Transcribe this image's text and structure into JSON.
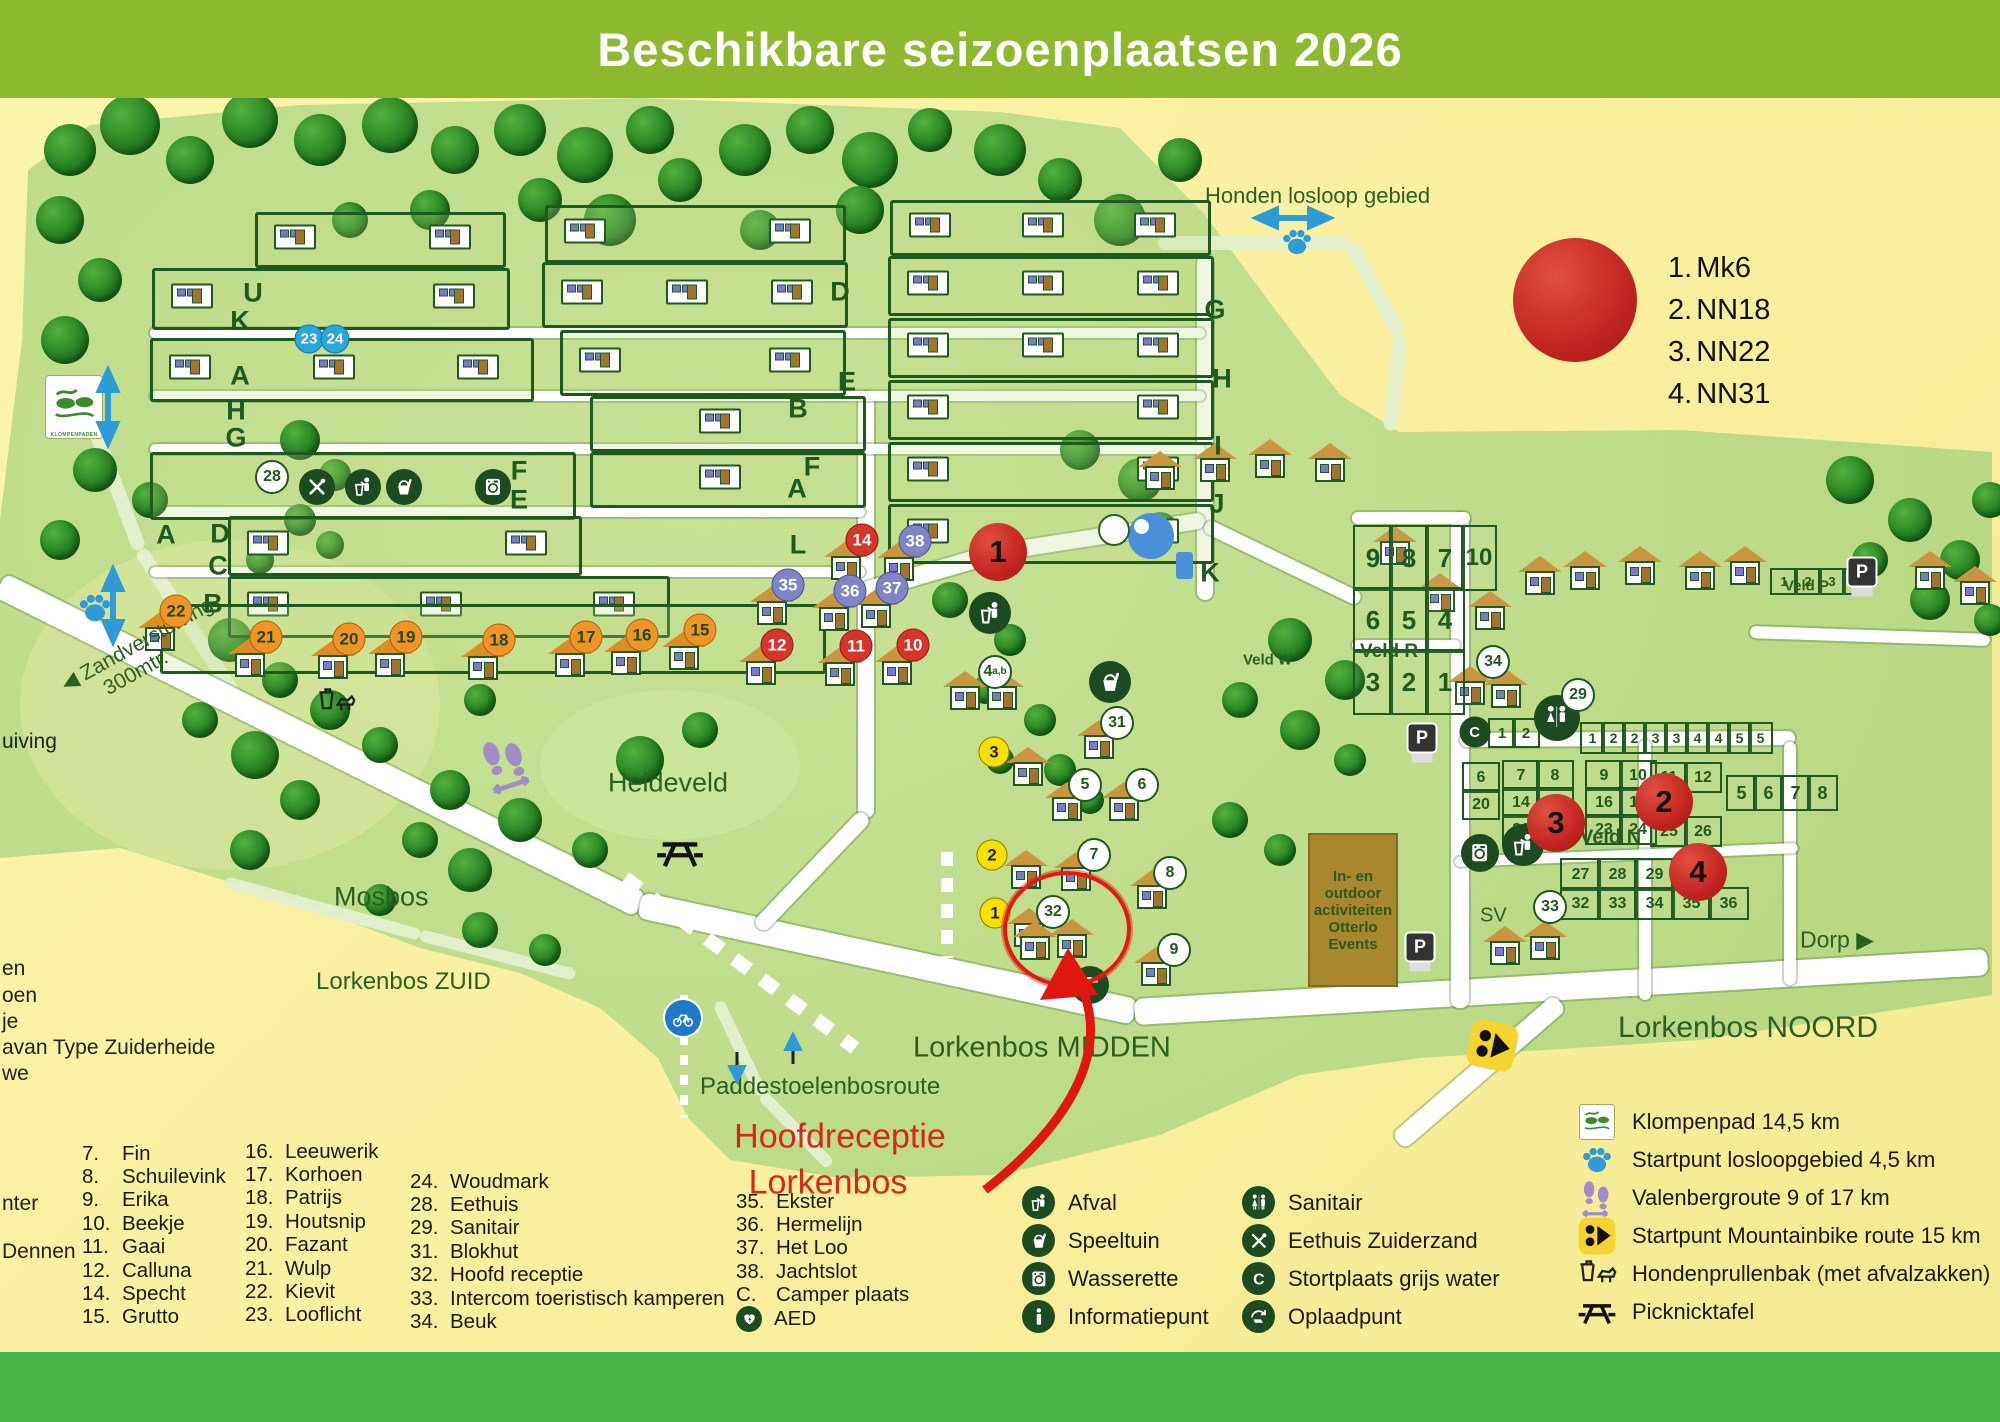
{
  "title": "Beschikbare seizoenplaatsen 2026",
  "availability_legend": {
    "items": [
      {
        "num": "1.",
        "label": "Mk6"
      },
      {
        "num": "2.",
        "label": "NN18"
      },
      {
        "num": "3.",
        "label": "NN22"
      },
      {
        "num": "4.",
        "label": "NN31"
      }
    ]
  },
  "highlight": {
    "line1": "Hoofdreceptie",
    "line2": "Lorkenbos"
  },
  "map_labels": [
    {
      "id": "honden",
      "text": "Honden losloop gebied",
      "x": 1205,
      "y": 196,
      "size": 22
    },
    {
      "id": "heideveld",
      "text": "Heideveld",
      "x": 608,
      "y": 783,
      "size": 27
    },
    {
      "id": "mosbos",
      "text": "Mosbos",
      "x": 334,
      "y": 897,
      "size": 27
    },
    {
      "id": "zuid",
      "text": "Lorkenbos ZUID",
      "x": 316,
      "y": 982,
      "size": 24
    },
    {
      "id": "midden",
      "text": "Lorkenbos MIDDEN",
      "x": 913,
      "y": 1048,
      "size": 29
    },
    {
      "id": "noord",
      "text": "Lorkenbos NOORD",
      "x": 1618,
      "y": 1028,
      "size": 30
    },
    {
      "id": "paddestoelen",
      "text": "Paddestoelenbosroute",
      "x": 700,
      "y": 1087,
      "size": 24
    },
    {
      "id": "zandverstuiving",
      "text": "◀ Zandverstuiving\n      300mtr.",
      "x": 58,
      "y": 655,
      "size": 21,
      "rot": -29
    },
    {
      "id": "veld-r",
      "text": "Veld R",
      "x": 1360,
      "y": 652,
      "size": 19,
      "bold": true
    },
    {
      "id": "veld-n",
      "text": "Veld N",
      "x": 1580,
      "y": 838,
      "size": 20,
      "bold": true
    },
    {
      "id": "veld-w",
      "text": "Veld W",
      "x": 1243,
      "y": 660,
      "size": 15,
      "bold": true
    },
    {
      "id": "veld-p",
      "text": "Veld P",
      "x": 1784,
      "y": 586,
      "size": 15,
      "bold": true
    },
    {
      "id": "sv",
      "text": "SV",
      "x": 1480,
      "y": 916,
      "size": 20
    },
    {
      "id": "dorp",
      "text": "Dorp ▶",
      "x": 1800,
      "y": 940,
      "size": 23
    }
  ],
  "events_box_text": "In- en\noutdoor\nactiviteiten\nOtterlo\nEvents",
  "klompenpad_sign_text": "KLOMPENPADEN",
  "row_letters": [
    {
      "ch": "U",
      "x": 253,
      "y": 293
    },
    {
      "ch": "K",
      "x": 240,
      "y": 321
    },
    {
      "ch": "A",
      "x": 240,
      "y": 376
    },
    {
      "ch": "H",
      "x": 236,
      "y": 411
    },
    {
      "ch": "G",
      "x": 236,
      "y": 438
    },
    {
      "ch": "A",
      "x": 166,
      "y": 535
    },
    {
      "ch": "D",
      "x": 220,
      "y": 534
    },
    {
      "ch": "C",
      "x": 218,
      "y": 566
    },
    {
      "ch": "B",
      "x": 213,
      "y": 604
    },
    {
      "ch": "D",
      "x": 840,
      "y": 292
    },
    {
      "ch": "E",
      "x": 847,
      "y": 382
    },
    {
      "ch": "B",
      "x": 798,
      "y": 409
    },
    {
      "ch": "F",
      "x": 812,
      "y": 467
    },
    {
      "ch": "A",
      "x": 797,
      "y": 489
    },
    {
      "ch": "L",
      "x": 798,
      "y": 545
    },
    {
      "ch": "F",
      "x": 519,
      "y": 471
    },
    {
      "ch": "E",
      "x": 519,
      "y": 500
    },
    {
      "ch": "G",
      "x": 1215,
      "y": 310
    },
    {
      "ch": "H",
      "x": 1222,
      "y": 379
    },
    {
      "ch": "I",
      "x": 1218,
      "y": 446
    },
    {
      "ch": "J",
      "x": 1217,
      "y": 504
    },
    {
      "ch": "K",
      "x": 1210,
      "y": 573
    }
  ],
  "markers": [
    {
      "n": "23",
      "t": "blue",
      "x": 309,
      "y": 339
    },
    {
      "n": "24",
      "t": "blue",
      "x": 335,
      "y": 339
    },
    {
      "n": "28",
      "t": "white",
      "x": 272,
      "y": 477
    },
    {
      "n": "22",
      "t": "orange",
      "x": 176,
      "y": 611
    },
    {
      "n": "21",
      "t": "orange",
      "x": 266,
      "y": 637
    },
    {
      "n": "20",
      "t": "orange",
      "x": 349,
      "y": 639
    },
    {
      "n": "19",
      "t": "orange",
      "x": 406,
      "y": 637
    },
    {
      "n": "18",
      "t": "orange",
      "x": 499,
      "y": 640
    },
    {
      "n": "17",
      "t": "orange",
      "x": 586,
      "y": 637
    },
    {
      "n": "16",
      "t": "orange",
      "x": 642,
      "y": 635
    },
    {
      "n": "15",
      "t": "orange",
      "x": 700,
      "y": 630
    },
    {
      "n": "14",
      "t": "red",
      "x": 862,
      "y": 540
    },
    {
      "n": "12",
      "t": "red",
      "x": 777,
      "y": 645
    },
    {
      "n": "11",
      "t": "red",
      "x": 856,
      "y": 646
    },
    {
      "n": "10",
      "t": "red",
      "x": 913,
      "y": 645
    },
    {
      "n": "38",
      "t": "purple",
      "x": 915,
      "y": 541
    },
    {
      "n": "35",
      "t": "purple",
      "x": 788,
      "y": 585
    },
    {
      "n": "36",
      "t": "purple",
      "x": 850,
      "y": 591
    },
    {
      "n": "37",
      "t": "purple",
      "x": 892,
      "y": 588
    },
    {
      "n": "1",
      "t": "big",
      "x": 998,
      "y": 552
    },
    {
      "n": "2",
      "t": "big",
      "x": 1664,
      "y": 802
    },
    {
      "n": "3",
      "t": "big",
      "x": 1556,
      "y": 823
    },
    {
      "n": "4",
      "t": "big",
      "x": 1698,
      "y": 872
    },
    {
      "n": "4",
      "sup": "a,b",
      "t": "white",
      "x": 995,
      "y": 672
    },
    {
      "n": "3",
      "t": "yellow",
      "x": 994,
      "y": 752
    },
    {
      "n": "2",
      "t": "yellow",
      "x": 992,
      "y": 855
    },
    {
      "n": "1",
      "t": "yellow",
      "x": 995,
      "y": 913
    },
    {
      "n": "31",
      "t": "white",
      "x": 1117,
      "y": 723
    },
    {
      "n": "5",
      "t": "white",
      "x": 1085,
      "y": 785
    },
    {
      "n": "6",
      "t": "white",
      "x": 1142,
      "y": 785
    },
    {
      "n": "7",
      "t": "white",
      "x": 1094,
      "y": 855
    },
    {
      "n": "8",
      "t": "white",
      "x": 1170,
      "y": 873
    },
    {
      "n": "9",
      "t": "white",
      "x": 1174,
      "y": 950
    },
    {
      "n": "32",
      "t": "white",
      "x": 1053,
      "y": 912
    },
    {
      "n": "34",
      "t": "white",
      "x": 1493,
      "y": 662
    },
    {
      "n": "29",
      "t": "white",
      "x": 1578,
      "y": 695
    },
    {
      "n": "33",
      "t": "white",
      "x": 1550,
      "y": 907
    }
  ],
  "veld_r": {
    "rows": [
      [
        "9",
        "8",
        "7"
      ],
      [
        "6",
        "5",
        "4"
      ],
      [
        "3",
        "2",
        "1"
      ]
    ],
    "extra": "10"
  },
  "camper_cells": [
    "1",
    "2"
  ],
  "w_cells": [
    "1",
    "2",
    "2",
    "3",
    "3",
    "4",
    "4",
    "5",
    "5"
  ],
  "veld_n": {
    "left_col": [
      "6",
      "20"
    ],
    "grid_a": [
      [
        "7",
        "8"
      ],
      [
        "14",
        "15"
      ],
      [
        "21"
      ]
    ],
    "grid_b": [
      [
        "9",
        "10"
      ],
      [
        "16",
        "17"
      ],
      [
        "23",
        "24"
      ]
    ],
    "grid_c": [
      [
        "11",
        "12"
      ],
      [
        "19"
      ],
      [
        "25",
        "26"
      ]
    ],
    "grid_d": [
      [
        "27",
        "28",
        "29",
        "30"
      ],
      [
        "32",
        "33",
        "34",
        "35",
        "36"
      ]
    ]
  },
  "veld_w_cells": [
    "5",
    "6",
    "7",
    "8"
  ],
  "veld_p_cells": [
    "1",
    "2",
    "3",
    "4"
  ],
  "legend_names": {
    "col1": [
      {
        "num": "7.",
        "name": "Fin"
      },
      {
        "num": "8.",
        "name": "Schuilevink"
      },
      {
        "num": "9.",
        "name": "Erika"
      },
      {
        "num": "10.",
        "name": "Beekje"
      },
      {
        "num": "11.",
        "name": "Gaai"
      },
      {
        "num": "12.",
        "name": "Calluna"
      },
      {
        "num": "14.",
        "name": "Specht"
      },
      {
        "num": "15.",
        "name": "Grutto"
      }
    ],
    "col2": [
      {
        "num": "16.",
        "name": "Leeuwerik"
      },
      {
        "num": "17.",
        "name": "Korhoen"
      },
      {
        "num": "18.",
        "name": "Patrijs"
      },
      {
        "num": "19.",
        "name": "Houtsnip"
      },
      {
        "num": "20.",
        "name": "Fazant"
      },
      {
        "num": "21.",
        "name": "Wulp"
      },
      {
        "num": "22.",
        "name": "Kievit"
      },
      {
        "num": "23.",
        "name": "Looflicht"
      }
    ],
    "col3": [
      {
        "num": "24.",
        "name": "Woudmark"
      },
      {
        "num": "28.",
        "name": "Eethuis"
      },
      {
        "num": "29.",
        "name": "Sanitair"
      },
      {
        "num": "31.",
        "name": "Blokhut"
      },
      {
        "num": "32.",
        "name": "Hoofd receptie"
      },
      {
        "num": "33.",
        "name": "Intercom toeristisch kamperen"
      },
      {
        "num": "34.",
        "name": "Beuk"
      }
    ],
    "col4": [
      {
        "num": "35.",
        "name": "Ekster"
      },
      {
        "num": "36.",
        "name": "Hermelijn"
      },
      {
        "num": "37.",
        "name": "Het Loo"
      },
      {
        "num": "38.",
        "name": "Jachtslot"
      },
      {
        "num": "C.",
        "name": "Camper plaats"
      },
      {
        "num": "aed",
        "name": "AED"
      }
    ]
  },
  "edge_texts": [
    {
      "text": "uiving",
      "x": 2,
      "y": 730
    },
    {
      "text": "en",
      "x": 2,
      "y": 957
    },
    {
      "text": "oen",
      "x": 2,
      "y": 984
    },
    {
      "text": "je",
      "x": 2,
      "y": 1010
    },
    {
      "text": "avan Type Zuiderheide",
      "x": 2,
      "y": 1036
    },
    {
      "text": "we",
      "x": 2,
      "y": 1062
    },
    {
      "text": "nter",
      "x": 2,
      "y": 1192
    },
    {
      "text": "Dennen",
      "x": 2,
      "y": 1240
    }
  ],
  "facility_legend": {
    "col_a": [
      {
        "icon": "afval",
        "label": "Afval"
      },
      {
        "icon": "speeltuin",
        "label": "Speeltuin"
      },
      {
        "icon": "wasserette",
        "label": "Wasserette"
      },
      {
        "icon": "info",
        "label": "Informatiepunt"
      }
    ],
    "col_b": [
      {
        "icon": "sanitair",
        "label": "Sanitair"
      },
      {
        "icon": "eethuis",
        "label": "Eethuis Zuiderzand"
      },
      {
        "icon": "stort",
        "label": "Stortplaats grijs water"
      },
      {
        "icon": "oplaad",
        "label": "Oplaadpunt"
      }
    ]
  },
  "route_legend": [
    {
      "icon": "klompenpad",
      "label": "Klompenpad 14,5 km"
    },
    {
      "icon": "paw",
      "label": "Startpunt losloopgebied 4,5 km"
    },
    {
      "icon": "footprints",
      "label": "Valenbergroute 9 of 17 km"
    },
    {
      "icon": "mtb",
      "label": "Startpunt Mountainbike route 15 km"
    },
    {
      "icon": "dogbin",
      "label": "Hondenprullenbak (met afvalzakken)"
    },
    {
      "icon": "picnic",
      "label": "Picknicktafel"
    }
  ],
  "colors": {
    "header_green": "#8CB92E",
    "footer_green": "#47B348",
    "map_green": "#BCDB88",
    "bg_yellow": "#FBF2A2",
    "marker_red": "#D6352B",
    "marker_orange": "#F09426",
    "marker_blue": "#29A7DC",
    "marker_purple": "#7F84C8",
    "marker_yellow": "#F8E000",
    "icon_dark_green": "#1C4A21",
    "accent_red": "#D8261A"
  }
}
